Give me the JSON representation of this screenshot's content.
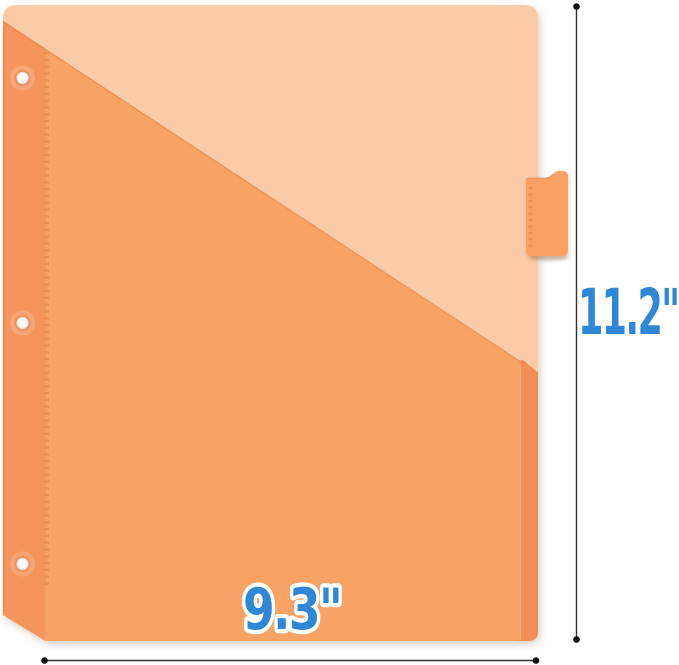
{
  "meta": {
    "alt": "Orange 3-ring binder pocket divider with side index tab, annotated with height and width dimensions"
  },
  "dimensions": {
    "height_label": "11.2\"",
    "width_label": "9.3\""
  },
  "colors": {
    "background": "#ffffff",
    "sheet": "#fccba6",
    "pocket": "#f9a266",
    "binding_strip": "#f5955d",
    "fold_strip": "#f18e55",
    "tab": "#f9a063",
    "stitch": "#e98c53",
    "hole_edge": "rgba(205,130,85,0.45)",
    "label_blue": "#2f87d7",
    "label_outline": "#ffffff",
    "dimension_line": "#333333",
    "dimension_dot": "#111111"
  }
}
